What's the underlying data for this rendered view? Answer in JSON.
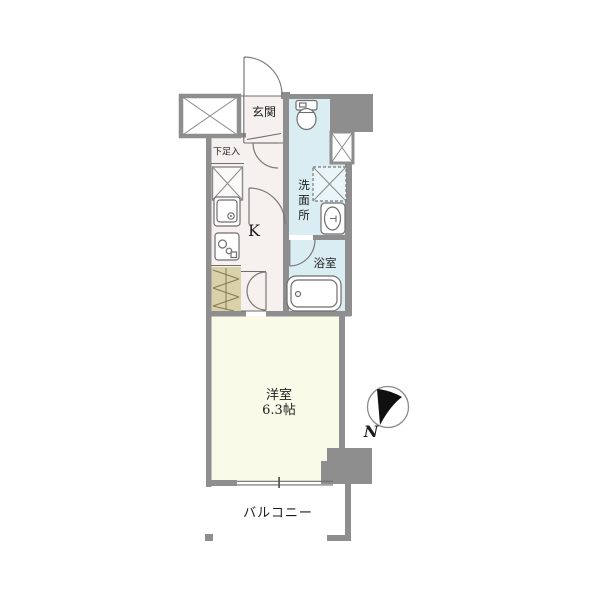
{
  "title": "apartment-floor-plan",
  "colors": {
    "wall": "#8e8e8e",
    "line": "#6e6e6e",
    "floor_warm": "#f6f1ee",
    "floor_wet": "#d9edf3",
    "floor_pan": "#e9f5f9",
    "floor_room": "#fafae8",
    "floor_closet": "#d9d1a9",
    "floor_white": "#ffffff",
    "arrow": "#101010",
    "text": "#1c1c1c"
  },
  "labels": {
    "entrance": "玄関",
    "shoe_storage": "下足入",
    "kitchen": "K",
    "washroom_chars": [
      "洗",
      "面",
      "所"
    ],
    "bathroom": "浴室",
    "main_room": "洋室",
    "main_room_size": "6.3帖",
    "balcony": "バルコニー",
    "compass_north": "N"
  }
}
